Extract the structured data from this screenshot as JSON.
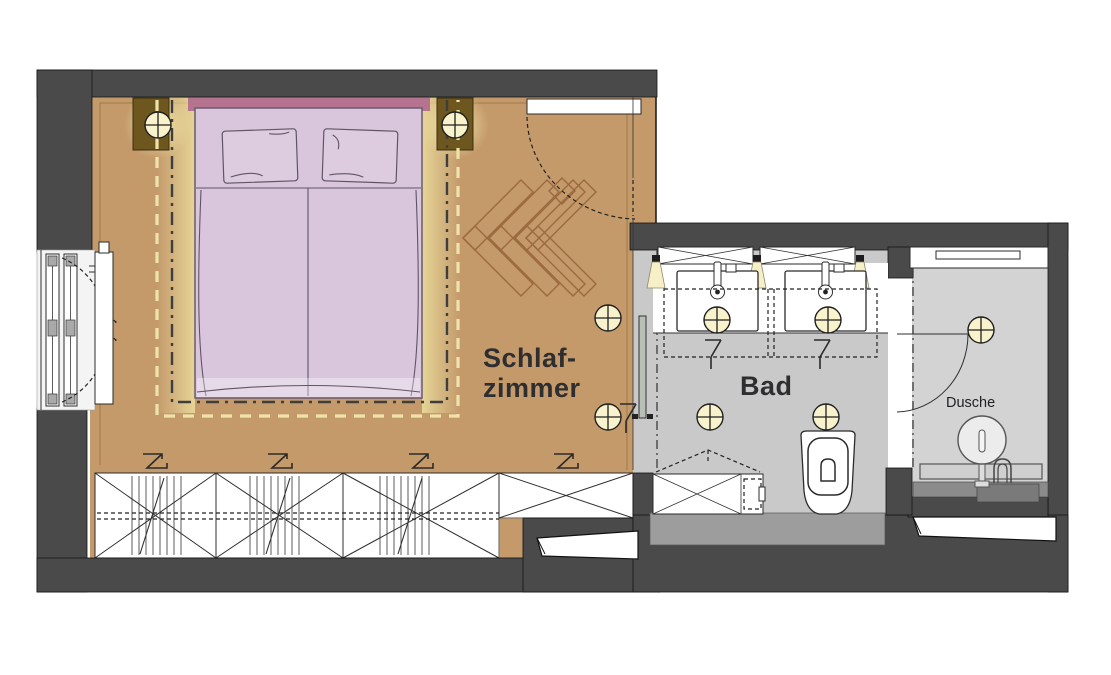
{
  "plan": {
    "rooms": {
      "bedroom": {
        "label_line1": "Schlaf-",
        "label_line2": "zimmer"
      },
      "bathroom": {
        "label": "Bad"
      },
      "shower": {
        "label": "Dusche"
      }
    },
    "colors": {
      "wall": "#4a4a4a",
      "floor_bedroom": "#c49a6b",
      "floor_bath": "#c9c9c9",
      "floor_shower": "#d3d3d3",
      "bed": "#d9c6dc",
      "headboard": "#b5738f",
      "nightstand": "#6e571f",
      "herringbone": "#9a6a3e",
      "led_dash": "#efe3ac",
      "light_fill": "#f8f3cd",
      "text": "#2e2e31"
    }
  }
}
